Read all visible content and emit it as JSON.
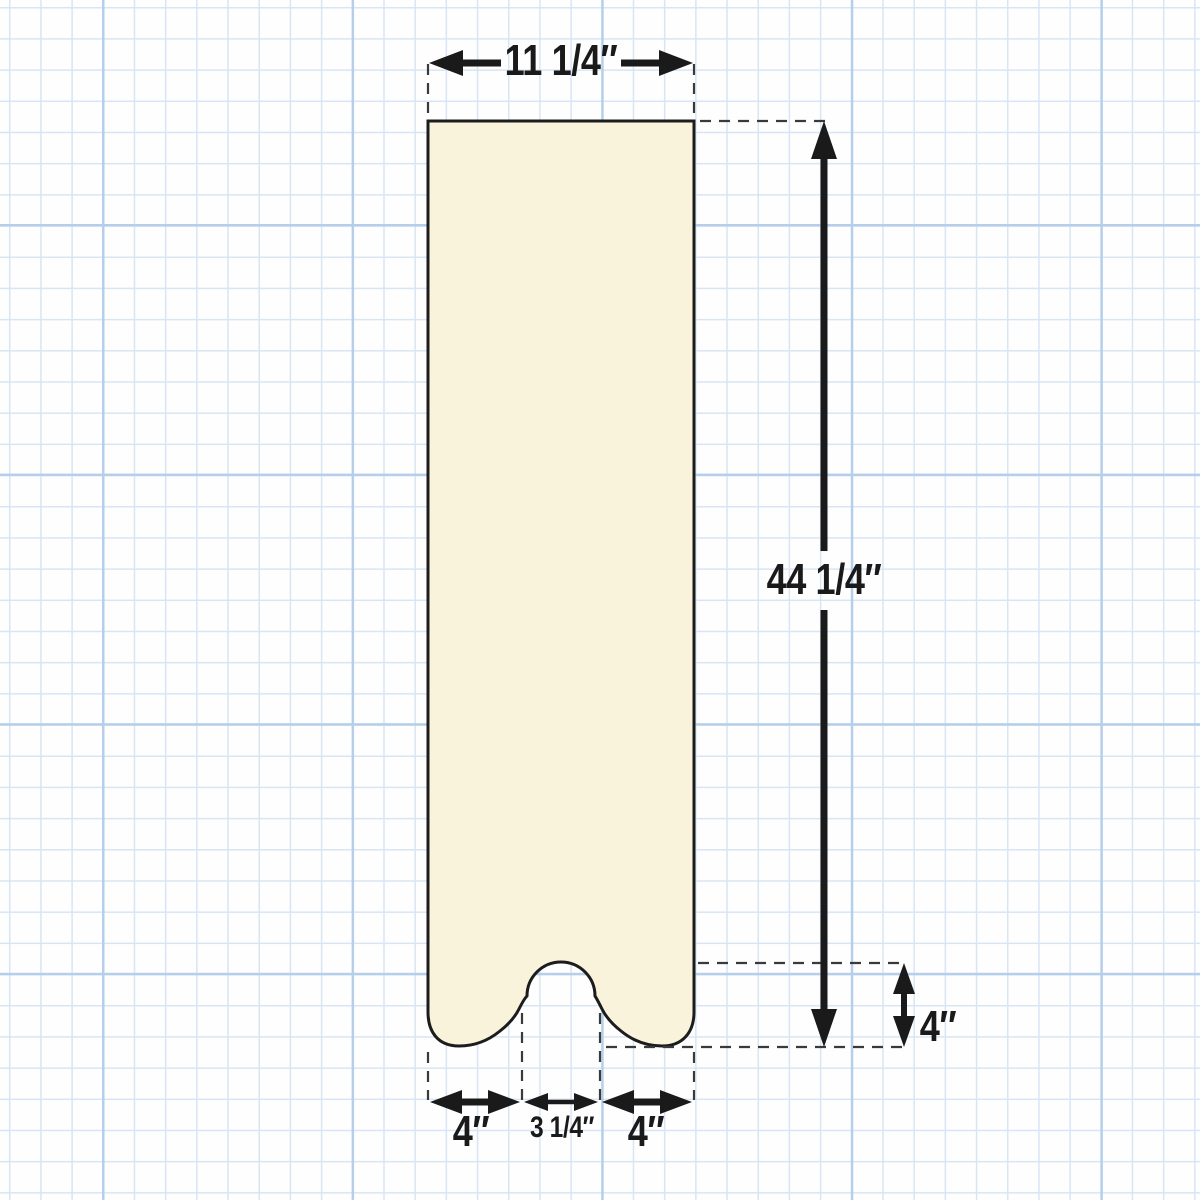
{
  "colors": {
    "background": "#FEFEFE",
    "grid_minor": "#D8E5F4",
    "grid_major": "#B5CFEA",
    "board_fill": "#FAF3DC",
    "board_outline": "#1C1C1C",
    "dimension_ink": "#1A1A1A",
    "dash_ink": "#3A3A3A"
  },
  "dimensions": {
    "top_width": "11 1/4″",
    "right_height": "44 1/4″",
    "foot_height": "4″",
    "bottom_left_foot": "4″",
    "bottom_center_notch": "3 1/4″",
    "bottom_right_foot": "4″"
  }
}
